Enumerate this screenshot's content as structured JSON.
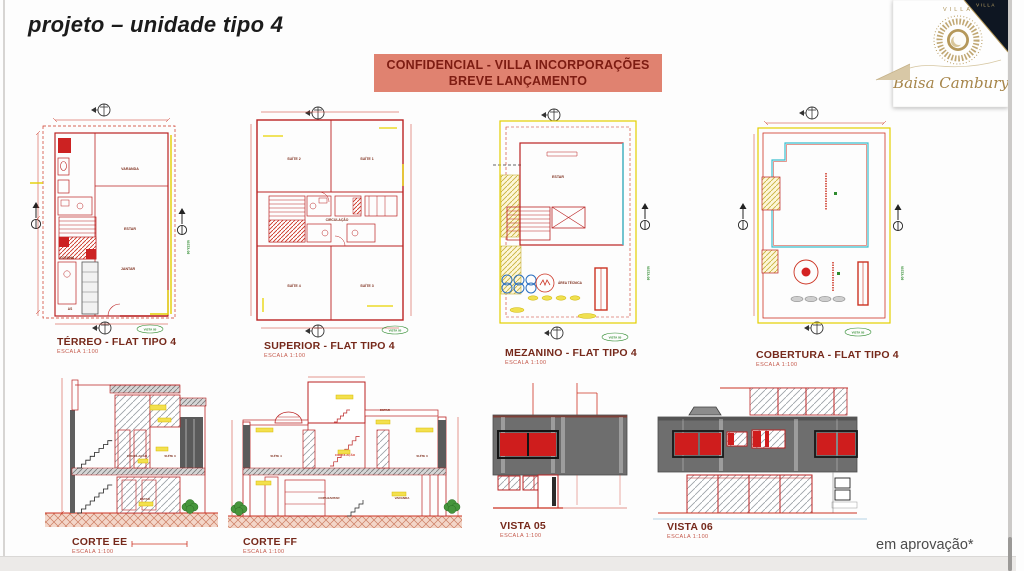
{
  "page": {
    "title": "projeto – unidade tipo 4",
    "approval_note": "em aprovação*"
  },
  "banner": {
    "line1": "CONFIDENCIAL - VILLA INCORPORAÇÕES",
    "line2": "BREVE LANÇAMENTO"
  },
  "logo": {
    "brand": "VILLA",
    "corner_brand": "VILLA",
    "script": "Baisa Cambury"
  },
  "plans": {
    "terreo": {
      "title": "TÉRREO - FLAT TIPO 4",
      "scale": "ESCALA 1:100",
      "rooms": {
        "varanda": "VARANDA",
        "estar": "ESTAR",
        "jantar": "JANTAR",
        "cozinha": "COZINHA",
        "as": "AS"
      },
      "side_marker": "VISTA 06",
      "bottom_marker": "VISTA 05"
    },
    "superior": {
      "title": "SUPERIOR - FLAT TIPO 4",
      "scale": "ESCALA 1:100",
      "rooms": {
        "suite1": "SUÍTE 1",
        "suite2": "SUÍTE 2",
        "suite3": "SUÍTE 3",
        "suite4": "SUÍTE 4",
        "circulacao": "CIRCULAÇÃO"
      },
      "bottom_marker": "VISTA 05"
    },
    "mezanino": {
      "title": "MEZANINO - FLAT TIPO 4",
      "scale": "ESCALA 1:100",
      "rooms": {
        "estar": "ESTAR",
        "area_tecnica": "ÁREA TÉCNICA"
      },
      "side_marker": "VISTA 06",
      "bottom_marker": "VISTA 05"
    },
    "cobertura": {
      "title": "COBERTURA - FLAT TIPO 4",
      "scale": "ESCALA 1:100",
      "side_marker": "VISTA 06",
      "bottom_marker": "VISTA 05"
    }
  },
  "sections": {
    "corte_ee": {
      "title": "CORTE EE",
      "scale": "ESCALA 1:100",
      "labels": {
        "circulacao": "CIRCULAÇÃO",
        "suite3": "SUÍTE 3",
        "estar": "ESTAR"
      }
    },
    "corte_ff": {
      "title": "CORTE FF",
      "scale": "ESCALA 1:100",
      "labels": {
        "estar": "ESTAR",
        "suite4": "SUÍTE 4",
        "circulacao": "CIRCULAÇÃO",
        "suite3": "SUÍTE 3",
        "copa_jantar": "COPA/JANTAR",
        "varanda": "VARANDA"
      }
    },
    "vista05": {
      "title": "VISTA 05",
      "scale": "ESCALA 1:100"
    },
    "vista06": {
      "title": "VISTA 06",
      "scale": "ESCALA 1:100"
    }
  },
  "colors": {
    "cad_red": "#cc3322",
    "cad_yellow": "#e3cf00",
    "cad_cyan": "#3bbfcf",
    "banner_bg": "#e08270",
    "banner_text": "#7d1c12",
    "elevation_gray": "#6e6e6e",
    "window_red": "#cf1d1d",
    "marker_green": "#2e8b2e",
    "logo_gold": "#ab8f52",
    "logo_navy": "#0e1622"
  }
}
